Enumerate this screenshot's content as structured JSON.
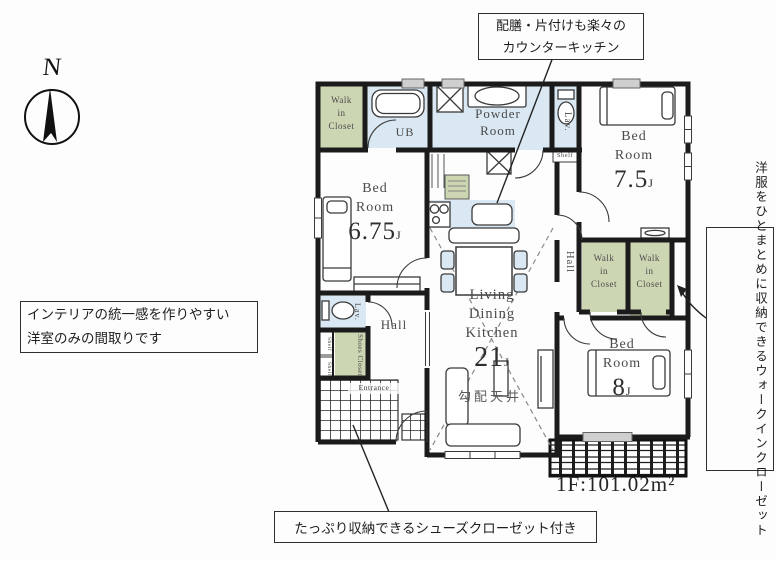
{
  "colors": {
    "wet_area": "#d9e8f2",
    "closet": "#ccd6b3",
    "wall": "#1b1b1b",
    "hatch": "#2a2a2a"
  },
  "compass": {
    "label": "N"
  },
  "annotations": {
    "kitchen": {
      "line1": "配膳・片付けも楽々の",
      "line2": "カウンターキッチン"
    },
    "interior": {
      "line1": "インテリアの統一感を作りやすい",
      "line2": "洋室のみの間取りです"
    },
    "closet": {
      "col1": "洋服をひとまとめに収納できる",
      "col2": "ウォークインクローゼット"
    },
    "shoes": {
      "text": "たっぷり収納できるシューズクローゼット付き"
    }
  },
  "floor": {
    "area_label": "1F:101.02m²"
  },
  "labels": {
    "walk_in_closet": {
      "l1": "Walk",
      "l2": "in",
      "l3": "Closet"
    },
    "ub": "UB",
    "powder": {
      "l1": "Powder",
      "l2": "Room"
    },
    "lav": "Lav.",
    "shelf": "Shelf",
    "hall": "Hall",
    "shoes_closet": "Shoes Closet",
    "entrance": "Entrance",
    "slope_ceiling": "勾配天井",
    "bed1": {
      "n1": "Bed",
      "n2": "Room",
      "size": "7.5",
      "unit": "J"
    },
    "bed2": {
      "n1": "Bed",
      "n2": "Room",
      "size": "6.75",
      "unit": "J"
    },
    "bed3": {
      "n1": "Bed",
      "n2": "Room",
      "size": "8",
      "unit": "J"
    },
    "ldk": {
      "n1": "Living",
      "n2": "Dining",
      "n3": "Kitchen",
      "size": "21",
      "unit": "J"
    }
  }
}
